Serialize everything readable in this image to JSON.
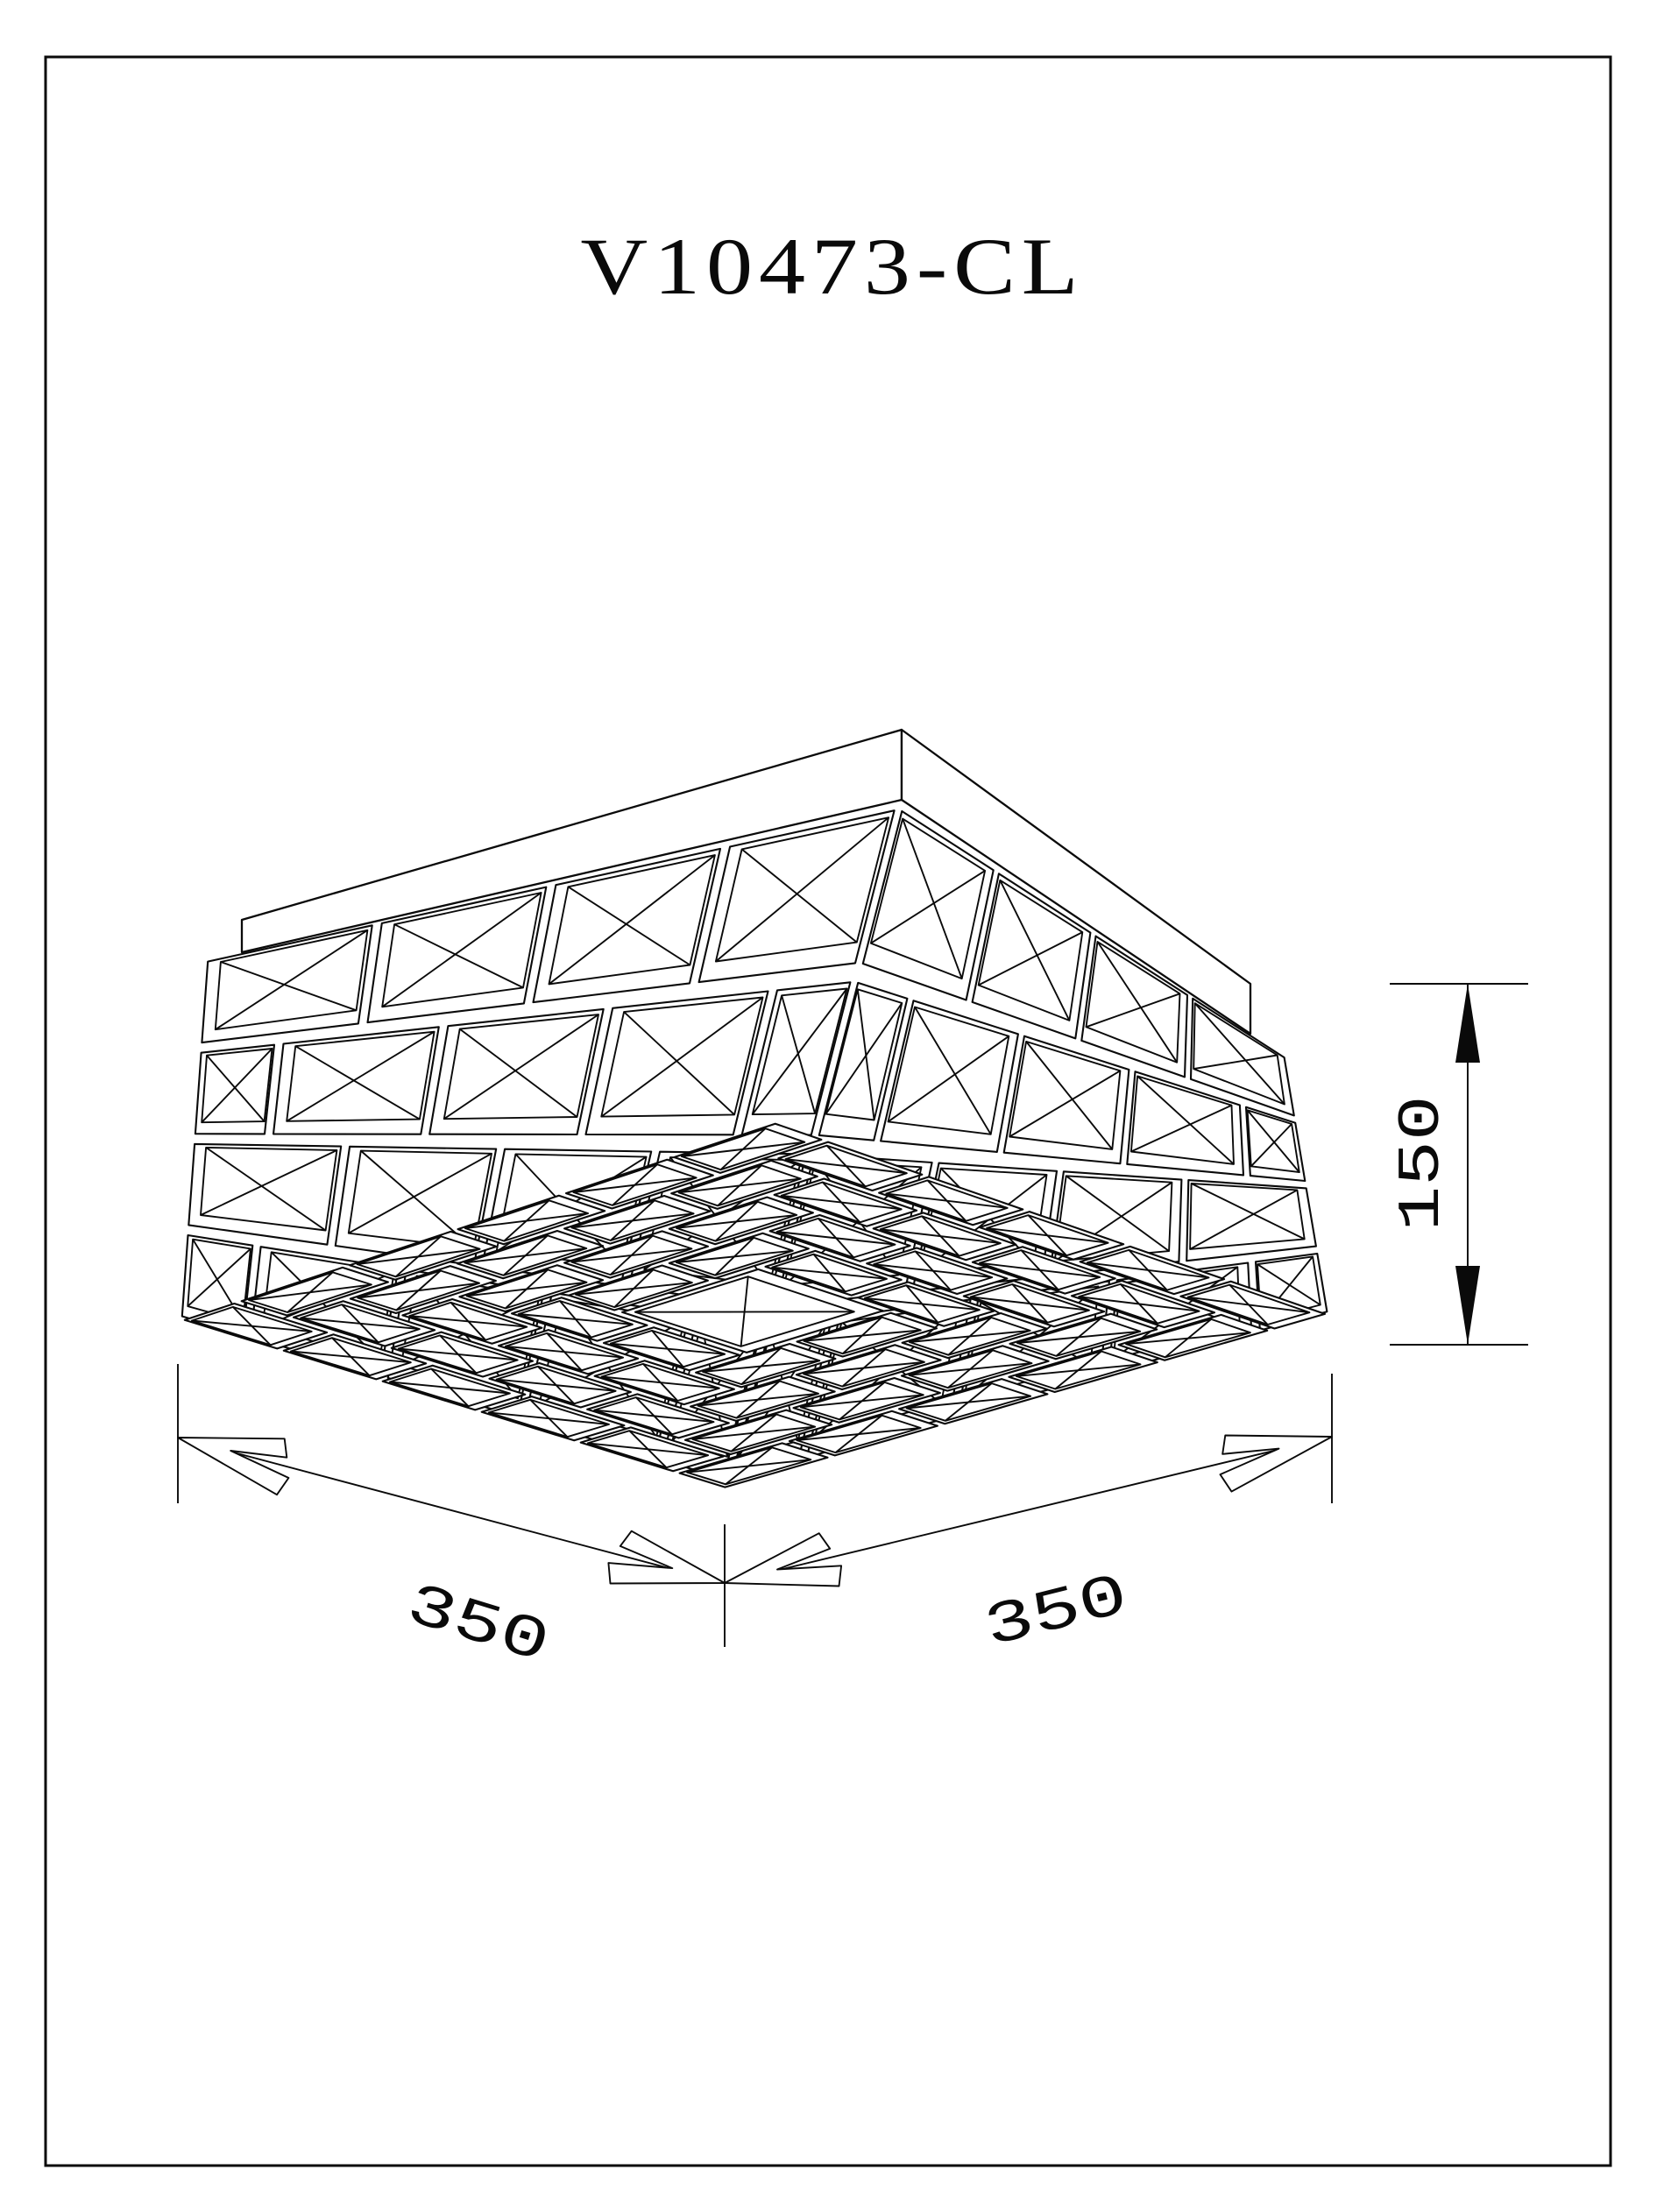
{
  "title": {
    "product_code": "V10473-CL"
  },
  "dimensions": {
    "height": {
      "value": "150"
    },
    "side_left": {
      "value": "350"
    },
    "side_right": {
      "value": "350"
    }
  },
  "figure": {
    "subject": "crystal-flush-mount-ceiling-lamp-isometric-drawing"
  },
  "colors": {
    "ink": "#0a0a0a",
    "paper": "#ffffff"
  }
}
